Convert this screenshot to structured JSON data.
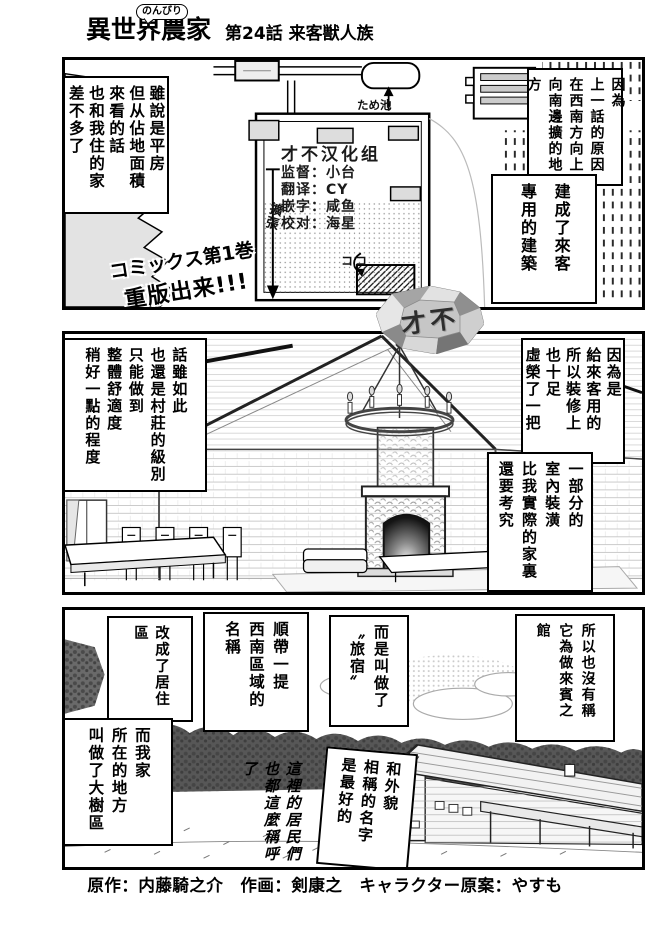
{
  "title": {
    "main_pre": "異世界",
    "bubble": "のんびり",
    "main_post": "農家",
    "chapter": "第24話 来客獣人族"
  },
  "panel1": {
    "bubble_left": "雖說是平房\n但从佔地面積\n來看的話\n也和我住的家\n差不多了",
    "bubble_right_top": "因為\n上一話的原因\n在西南方向上\n向南邊擴的地方",
    "bubble_right_bottom": "建成了來客\n專用的建築",
    "reprint_line1": "コミックス第1巻",
    "reprint_line2": "重版出来!!!",
    "labels": {
      "pond": "ため池",
      "expand": "擴張",
      "here": "ココ"
    },
    "scanlation": {
      "group": "才不汉化组",
      "roles": [
        "监督：小台",
        "翻译：CY",
        "嵌字：咸鱼",
        "校对：海星"
      ]
    }
  },
  "gem": {
    "text": "才不"
  },
  "panel2": {
    "bubble_left": "話雖如此\n也還是村莊的級別\n只能做到\n整體舒適度\n稍好一點的程度",
    "bubble_right_top": "因為是\n給來客用的\n所以裝修上\n也十足\n虛榮了一把",
    "bubble_right_bottom": "一部分的\n室內裝潢\n比我實際的家裏\n還要考究"
  },
  "panel3": {
    "bubble_rezone": "改成了居住區",
    "bubble_my_area": "而我家\n所在的地方\n叫做了大樹區",
    "bubble_aside": "順帶一提\n西南區域的\n名稱",
    "handwritten": "這裡的居民們\n也都這麼稱呼了",
    "bubble_inn": "而是叫做了\n〝旅宿〟",
    "bubble_best_name": "和外貌\n相稱的名字\n是最好的",
    "bubble_guesthouse": "所以也沒有稱\n它為做來賓之館"
  },
  "footer": {
    "credits": "原作：内藤騎之介　作画：剣康之　キャラクター原案：やすも"
  }
}
